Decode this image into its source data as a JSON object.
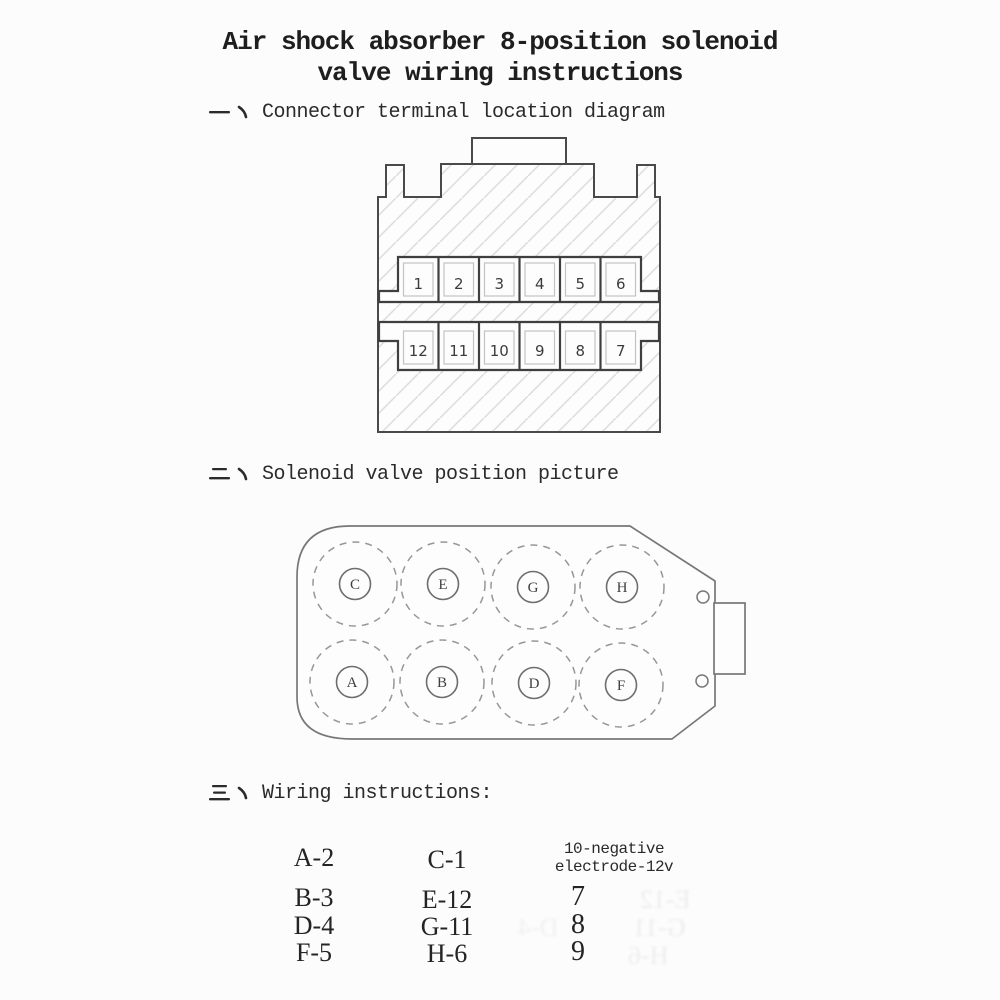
{
  "page": {
    "title_line1": "Air shock absorber 8-position solenoid",
    "title_line2": "valve wiring instructions"
  },
  "sections": [
    {
      "numeral": "一、",
      "label": "Connector terminal location diagram"
    },
    {
      "numeral": "二、",
      "label": "Solenoid valve position picture"
    },
    {
      "numeral": "三、",
      "label": "Wiring instructions:"
    }
  ],
  "connector": {
    "top_row": [
      "1",
      "2",
      "3",
      "4",
      "5",
      "6"
    ],
    "bottom_row": [
      "12",
      "11",
      "10",
      "9",
      "8",
      "7"
    ]
  },
  "valve": {
    "top_row": [
      "C",
      "E",
      "G",
      "H"
    ],
    "bottom_row": [
      "A",
      "B",
      "D",
      "F"
    ]
  },
  "wiring": {
    "col1": [
      "A-2",
      "B-3",
      "D-4",
      "F-5"
    ],
    "col2": [
      "C-1",
      "E-12",
      "G-11",
      "H-6"
    ],
    "col3_header_line1": "10-negative",
    "col3_header_line2": "electrode-12v",
    "col3": [
      "7",
      "8",
      "9"
    ]
  },
  "colors": {
    "ink": "#2e2e2e",
    "outline": "#4a4a4a",
    "light_outline": "#777777",
    "hatch": "#dcdcdc",
    "paper": "#fcfcfc"
  }
}
